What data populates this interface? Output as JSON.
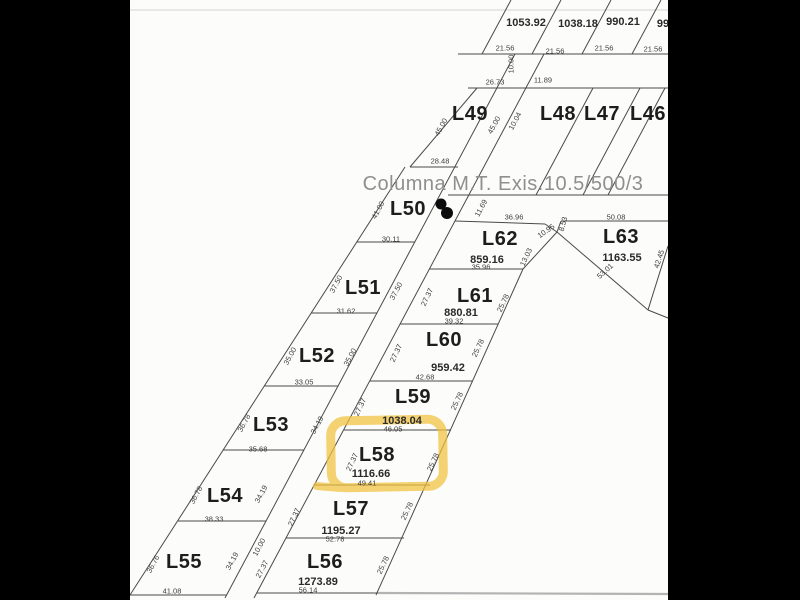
{
  "note": {
    "text": "Columna M.T. Exis.10.5/500/3"
  },
  "highlight": {
    "lot": "L58",
    "color": "#f2c33d"
  },
  "colors": {
    "paper": "#fcfcfb",
    "surround": "#000000",
    "line": "#4a4a4a",
    "lot_text": "#1d1d1d",
    "dim_text": "#3d3d3d",
    "note_text": "#8f8f8f",
    "highlight": "#f2c33d"
  },
  "parcels": [
    {
      "id": "L46"
    },
    {
      "id": "L47"
    },
    {
      "id": "L48"
    },
    {
      "id": "L49"
    },
    {
      "id": "L50"
    },
    {
      "id": "L51"
    },
    {
      "id": "L52"
    },
    {
      "id": "L53"
    },
    {
      "id": "L54"
    },
    {
      "id": "L55"
    },
    {
      "id": "L56",
      "area": "1273.89"
    },
    {
      "id": "L57",
      "area": "1195.27"
    },
    {
      "id": "L58",
      "area": "1116.66",
      "highlighted": true
    },
    {
      "id": "L59",
      "area": "1038.04"
    },
    {
      "id": "L60",
      "area": "959.42"
    },
    {
      "id": "L61",
      "area": "880.81"
    },
    {
      "id": "L62",
      "area": "859.16"
    },
    {
      "id": "L63",
      "area": "1163.55"
    }
  ],
  "top_row_areas": [
    "1053.92",
    "1038.18",
    "990.21",
    "99"
  ],
  "labels": [
    {
      "n": "top-area-1",
      "t": "1053.92",
      "x": 526,
      "y": 23,
      "c": "area"
    },
    {
      "n": "top-area-2",
      "t": "1038.18",
      "x": 578,
      "y": 24,
      "c": "area"
    },
    {
      "n": "top-area-3",
      "t": "990.21",
      "x": 623,
      "y": 22,
      "c": "area"
    },
    {
      "n": "top-area-4",
      "t": "99",
      "x": 663,
      "y": 24,
      "c": "area"
    },
    {
      "n": "dim-21-56-a",
      "t": "21.56",
      "x": 505,
      "y": 48,
      "c": "dim"
    },
    {
      "n": "dim-21-56-b",
      "t": "21.56",
      "x": 555,
      "y": 51,
      "c": "dim"
    },
    {
      "n": "dim-21-56-c",
      "t": "21.56",
      "x": 604,
      "y": 48,
      "c": "dim"
    },
    {
      "n": "dim-21-56-d",
      "t": "21.56",
      "x": 653,
      "y": 49,
      "c": "dim"
    },
    {
      "n": "dim-10-00-top",
      "t": "10.00",
      "x": 511,
      "y": 64,
      "c": "dim",
      "r": -90
    },
    {
      "n": "dim-26-73",
      "t": "26.73",
      "x": 495,
      "y": 82,
      "c": "dim"
    },
    {
      "n": "dim-11-89",
      "t": "11.89",
      "x": 543,
      "y": 80,
      "c": "dim"
    },
    {
      "n": "lot-L49",
      "t": "L49",
      "x": 470,
      "y": 114,
      "c": "lot"
    },
    {
      "n": "lot-L48",
      "t": "L48",
      "x": 558,
      "y": 114,
      "c": "lot"
    },
    {
      "n": "lot-L47",
      "t": "L47",
      "x": 602,
      "y": 114,
      "c": "lot"
    },
    {
      "n": "lot-L46",
      "t": "L46",
      "x": 648,
      "y": 114,
      "c": "lot"
    },
    {
      "n": "dim-45-00-a",
      "t": "45.00",
      "x": 441,
      "y": 127,
      "c": "dim",
      "r": -62
    },
    {
      "n": "dim-45-00-b",
      "t": "45.00",
      "x": 494,
      "y": 125,
      "c": "dim",
      "r": -62
    },
    {
      "n": "dim-10-04",
      "t": "10.04",
      "x": 515,
      "y": 121,
      "c": "dim",
      "r": -62
    },
    {
      "n": "dim-28-48",
      "t": "28.48",
      "x": 440,
      "y": 161,
      "c": "dim"
    },
    {
      "n": "lot-L50",
      "t": "L50",
      "x": 408,
      "y": 209,
      "c": "lot"
    },
    {
      "n": "dim-41-00",
      "t": "41.00",
      "x": 378,
      "y": 210,
      "c": "dim",
      "r": -62
    },
    {
      "n": "dim-11-69",
      "t": "11.69",
      "x": 481,
      "y": 208,
      "c": "dim",
      "r": -62
    },
    {
      "n": "dim-36-96",
      "t": "36.96",
      "x": 514,
      "y": 217,
      "c": "dim"
    },
    {
      "n": "dim-50-08",
      "t": "50.08",
      "x": 616,
      "y": 217,
      "c": "dim"
    },
    {
      "n": "dim-8-53",
      "t": "8.53",
      "x": 563,
      "y": 224,
      "c": "dim",
      "r": -75
    },
    {
      "n": "dim-10-95",
      "t": "10.95",
      "x": 546,
      "y": 231,
      "c": "dim",
      "r": -35
    },
    {
      "n": "lot-L62",
      "t": "L62",
      "x": 500,
      "y": 239,
      "c": "lot"
    },
    {
      "n": "area-L62",
      "t": "859.16",
      "x": 487,
      "y": 260,
      "c": "area"
    },
    {
      "n": "dim-35-96",
      "t": "35.96",
      "x": 481,
      "y": 267,
      "c": "dim"
    },
    {
      "n": "dim-13-03",
      "t": "13.03",
      "x": 526,
      "y": 257,
      "c": "dim",
      "r": -65
    },
    {
      "n": "lot-L63",
      "t": "L63",
      "x": 621,
      "y": 237,
      "c": "lot"
    },
    {
      "n": "area-L63",
      "t": "1163.55",
      "x": 622,
      "y": 258,
      "c": "area"
    },
    {
      "n": "dim-53-01",
      "t": "53.01",
      "x": 605,
      "y": 271,
      "c": "dim",
      "r": -42
    },
    {
      "n": "dim-42-45",
      "t": "42.45",
      "x": 659,
      "y": 259,
      "c": "dim",
      "r": -72
    },
    {
      "n": "dim-30-11",
      "t": "30.11",
      "x": 391,
      "y": 239,
      "c": "dim"
    },
    {
      "n": "lot-L51",
      "t": "L51",
      "x": 363,
      "y": 288,
      "c": "lot"
    },
    {
      "n": "dim-37-50-a",
      "t": "37.50",
      "x": 336,
      "y": 284,
      "c": "dim",
      "r": -62
    },
    {
      "n": "dim-37-50-b",
      "t": "37.50",
      "x": 396,
      "y": 291,
      "c": "dim",
      "r": -62
    },
    {
      "n": "dim-31-62",
      "t": "31.62",
      "x": 346,
      "y": 311,
      "c": "dim"
    },
    {
      "n": "lot-L61",
      "t": "L61",
      "x": 475,
      "y": 296,
      "c": "lot"
    },
    {
      "n": "area-L61",
      "t": "880.81",
      "x": 461,
      "y": 313,
      "c": "area"
    },
    {
      "n": "dim-39-32",
      "t": "39.32",
      "x": 454,
      "y": 321,
      "c": "dim"
    },
    {
      "n": "dim-25-78-L61",
      "t": "25.78",
      "x": 503,
      "y": 303,
      "c": "dim",
      "r": -65
    },
    {
      "n": "dim-27-37-L61",
      "t": "27.37",
      "x": 427,
      "y": 297,
      "c": "dim",
      "r": -65
    },
    {
      "n": "lot-L52",
      "t": "L52",
      "x": 317,
      "y": 356,
      "c": "lot"
    },
    {
      "n": "dim-35-00-a",
      "t": "35.00",
      "x": 290,
      "y": 356,
      "c": "dim",
      "r": -62
    },
    {
      "n": "dim-35-00-b",
      "t": "35.00",
      "x": 350,
      "y": 357,
      "c": "dim",
      "r": -62
    },
    {
      "n": "dim-33-05",
      "t": "33.05",
      "x": 304,
      "y": 382,
      "c": "dim"
    },
    {
      "n": "lot-L60",
      "t": "L60",
      "x": 444,
      "y": 340,
      "c": "lot"
    },
    {
      "n": "area-L60",
      "t": "959.42",
      "x": 448,
      "y": 368,
      "c": "area"
    },
    {
      "n": "dim-42-68",
      "t": "42.68",
      "x": 425,
      "y": 377,
      "c": "dim"
    },
    {
      "n": "dim-25-78-L60",
      "t": "25.78",
      "x": 478,
      "y": 348,
      "c": "dim",
      "r": -65
    },
    {
      "n": "dim-27-37-L60",
      "t": "27.37",
      "x": 396,
      "y": 353,
      "c": "dim",
      "r": -65
    },
    {
      "n": "lot-L53",
      "t": "L53",
      "x": 271,
      "y": 425,
      "c": "lot"
    },
    {
      "n": "dim-36-78-L53",
      "t": "36.78",
      "x": 244,
      "y": 423,
      "c": "dim",
      "r": -62
    },
    {
      "n": "dim-34-19-L53",
      "t": "34.19",
      "x": 317,
      "y": 425,
      "c": "dim",
      "r": -62
    },
    {
      "n": "dim-35-68",
      "t": "35.68",
      "x": 258,
      "y": 449,
      "c": "dim"
    },
    {
      "n": "lot-L59",
      "t": "L59",
      "x": 413,
      "y": 397,
      "c": "lot"
    },
    {
      "n": "area-L59",
      "t": "1038.04",
      "x": 402,
      "y": 421,
      "c": "area"
    },
    {
      "n": "dim-46-05",
      "t": "46.05",
      "x": 393,
      "y": 429,
      "c": "dim"
    },
    {
      "n": "dim-25-78-L59",
      "t": "25.78",
      "x": 457,
      "y": 401,
      "c": "dim",
      "r": -65
    },
    {
      "n": "dim-27-37-L59",
      "t": "27.37",
      "x": 360,
      "y": 407,
      "c": "dim",
      "r": -65
    },
    {
      "n": "lot-L54",
      "t": "L54",
      "x": 225,
      "y": 496,
      "c": "lot"
    },
    {
      "n": "dim-36-78-L54",
      "t": "36.78",
      "x": 196,
      "y": 495,
      "c": "dim",
      "r": -62
    },
    {
      "n": "dim-34-19-L54",
      "t": "34.19",
      "x": 261,
      "y": 494,
      "c": "dim",
      "r": -62
    },
    {
      "n": "dim-38-33",
      "t": "38.33",
      "x": 214,
      "y": 519,
      "c": "dim"
    },
    {
      "n": "lot-L58",
      "t": "L58",
      "x": 377,
      "y": 455,
      "c": "lot"
    },
    {
      "n": "area-L58",
      "t": "1116.66",
      "x": 371,
      "y": 474,
      "c": "area"
    },
    {
      "n": "dim-49-41",
      "t": "49.41",
      "x": 367,
      "y": 483,
      "c": "dim"
    },
    {
      "n": "dim-25-78-L58",
      "t": "25.78",
      "x": 433,
      "y": 462,
      "c": "dim",
      "r": -65
    },
    {
      "n": "dim-27-37-L58",
      "t": "27.37",
      "x": 352,
      "y": 462,
      "c": "dim",
      "r": -65
    },
    {
      "n": "lot-L57",
      "t": "L57",
      "x": 351,
      "y": 509,
      "c": "lot"
    },
    {
      "n": "area-L57",
      "t": "1195.27",
      "x": 341,
      "y": 531,
      "c": "area"
    },
    {
      "n": "dim-52-78",
      "t": "52.78",
      "x": 335,
      "y": 539,
      "c": "dim"
    },
    {
      "n": "dim-25-78-L57",
      "t": "25.78",
      "x": 407,
      "y": 511,
      "c": "dim",
      "r": -65
    },
    {
      "n": "dim-27-37-L57",
      "t": "27.37",
      "x": 294,
      "y": 517,
      "c": "dim",
      "r": -65
    },
    {
      "n": "lot-L55",
      "t": "L55",
      "x": 184,
      "y": 562,
      "c": "lot"
    },
    {
      "n": "dim-36-76",
      "t": "36.76",
      "x": 153,
      "y": 564,
      "c": "dim",
      "r": -62
    },
    {
      "n": "dim-34-19-L55",
      "t": "34.19",
      "x": 232,
      "y": 561,
      "c": "dim",
      "r": -62
    },
    {
      "n": "dim-41-08",
      "t": "41.08",
      "x": 172,
      "y": 591,
      "c": "dim"
    },
    {
      "n": "dim-10-00-bottom",
      "t": "10.00",
      "x": 259,
      "y": 547,
      "c": "dim",
      "r": -62
    },
    {
      "n": "dim-27-37-L56",
      "t": "27.37",
      "x": 262,
      "y": 569,
      "c": "dim",
      "r": -62
    },
    {
      "n": "lot-L56",
      "t": "L56",
      "x": 325,
      "y": 562,
      "c": "lot"
    },
    {
      "n": "area-L56",
      "t": "1273.89",
      "x": 318,
      "y": 582,
      "c": "area"
    },
    {
      "n": "dim-56-14",
      "t": "56.14",
      "x": 308,
      "y": 590,
      "c": "dim"
    },
    {
      "n": "dim-25-78-L56",
      "t": "25.78",
      "x": 383,
      "y": 565,
      "c": "dim",
      "r": -65
    }
  ]
}
